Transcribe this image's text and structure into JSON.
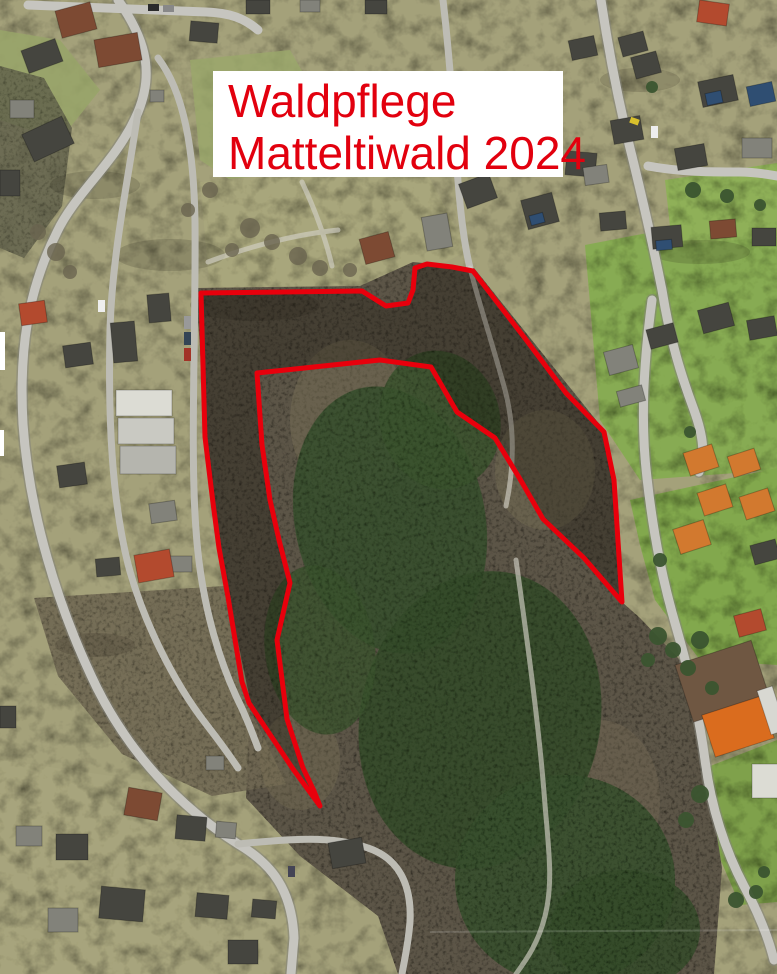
{
  "title_box": {
    "line1": "Waldpflege",
    "line2": "Matteltiwald 2024",
    "text_color": "#e2000e",
    "background": "#ffffff"
  },
  "annotation": {
    "name": "treatment-area-outline",
    "stroke_color": "#e8000c",
    "stroke_width": 5,
    "band_fill": "rgba(15,12,8,0.30)",
    "outer_boundary": [
      [
        320,
        806
      ],
      [
        293,
        769
      ],
      [
        249,
        703
      ],
      [
        242,
        682
      ],
      [
        228,
        597
      ],
      [
        219,
        548
      ],
      [
        213,
        503
      ],
      [
        205,
        437
      ],
      [
        201,
        293
      ],
      [
        362,
        291
      ],
      [
        386,
        306
      ],
      [
        408,
        303
      ],
      [
        413,
        290
      ],
      [
        415,
        268
      ],
      [
        427,
        264
      ],
      [
        452,
        267
      ],
      [
        473,
        271
      ],
      [
        524,
        337
      ],
      [
        566,
        393
      ],
      [
        604,
        432
      ],
      [
        614,
        480
      ],
      [
        622,
        602
      ]
    ],
    "inner_boundary": [
      [
        584,
        558
      ],
      [
        543,
        519
      ],
      [
        520,
        479
      ],
      [
        495,
        438
      ],
      [
        457,
        412
      ],
      [
        431,
        367
      ],
      [
        380,
        360
      ],
      [
        257,
        373
      ],
      [
        262,
        445
      ],
      [
        270,
        500
      ],
      [
        279,
        540
      ],
      [
        290,
        583
      ],
      [
        277,
        640
      ],
      [
        287,
        719
      ],
      [
        303,
        768
      ],
      [
        314,
        791
      ]
    ]
  }
}
